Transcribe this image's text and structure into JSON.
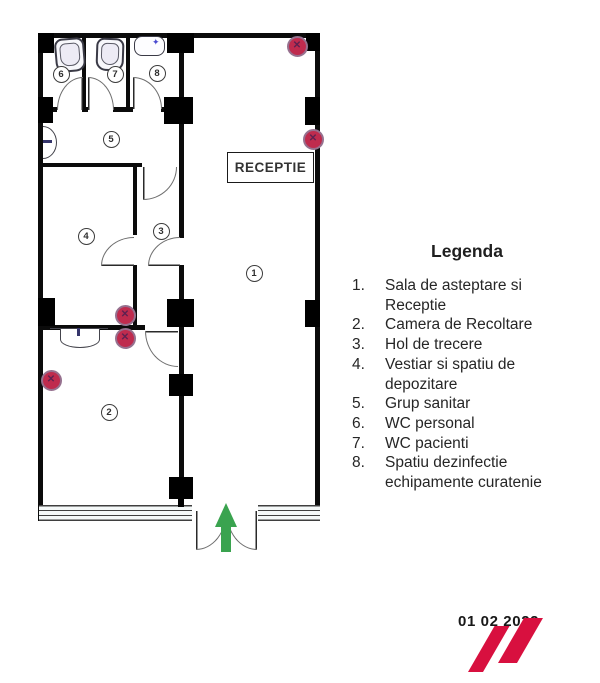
{
  "plan": {
    "reception_label": "RECEPTIE",
    "rooms": [
      "1",
      "2",
      "3",
      "4",
      "5",
      "6",
      "7",
      "8"
    ],
    "marker_glyph": "✕",
    "faucet_glyph": "✦",
    "marker_color": "#bf2b4e",
    "arrow_color": "#3aa34f",
    "entrance_arrow_icon": "up-arrow"
  },
  "legend": {
    "title": "Legenda",
    "items": [
      {
        "num": "1.",
        "text": "Sala de asteptare si Receptie"
      },
      {
        "num": "2.",
        "text": "Camera de Recoltare"
      },
      {
        "num": "3.",
        "text": "Hol de trecere"
      },
      {
        "num": "4.",
        "text": "Vestiar si spatiu de depozitare"
      },
      {
        "num": "5.",
        "text": "Grup sanitar"
      },
      {
        "num": "6.",
        "text": "WC personal"
      },
      {
        "num": "7.",
        "text": "WC pacienti"
      },
      {
        "num": "8.",
        "text": "Spatiu dezinfectie echipamente curatenie"
      }
    ]
  },
  "footer": {
    "date": "01 02 2022",
    "logo_color": "#d8103f"
  }
}
